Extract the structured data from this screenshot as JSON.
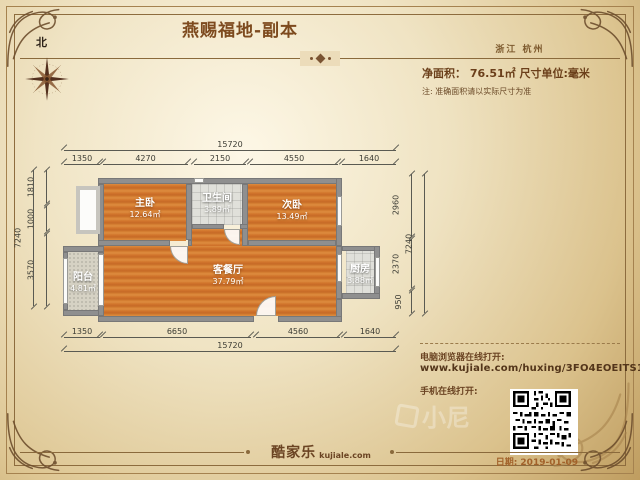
{
  "header": {
    "title": "燕赐福地-副本",
    "location": "浙江 杭州",
    "area_label": "净面积： 76.51㎡   尺寸单位:毫米",
    "note": "注: 准确面积请以实际尺寸为准",
    "compass_label": "北"
  },
  "plan": {
    "rooms": [
      {
        "name": "主卧",
        "area": "12.64㎡"
      },
      {
        "name": "卫生间",
        "area": "3.89㎡"
      },
      {
        "name": "次卧",
        "area": "13.49㎡"
      },
      {
        "name": "客餐厅",
        "area": "37.79㎡"
      },
      {
        "name": "阳台",
        "area": "4.81㎡"
      },
      {
        "name": "厨房",
        "area": "3.88㎡"
      }
    ],
    "dims": {
      "top_total": "15720",
      "top": [
        "1350",
        "4270",
        "2150",
        "4550",
        "1640"
      ],
      "bottom": [
        "1350",
        "6650",
        "4560",
        "1640"
      ],
      "bottom_total": "15720",
      "left": [
        "1810",
        "1000",
        "3570"
      ],
      "left_total": "7240",
      "right": [
        "2960",
        "2370",
        "950"
      ],
      "right_total": "7240"
    }
  },
  "footer": {
    "pc_open_label": "电脑浏览器在线打开:",
    "url": "www.kujiale.com/huxing/3FO4EOEITS10",
    "mobile_open_label": "手机在线打开:",
    "brand": "酷家乐",
    "brand_domain": "kujiale.com",
    "date": "日期: 2019-01-09",
    "watermark": "小尼"
  },
  "colors": {
    "accent_brown": "#7d4a1e",
    "wall_gray": "#8f8f8f",
    "wood_floor": "#d2752c",
    "tile_floor": "#d6d2c4",
    "parchment": "#ecdcba",
    "date_orange": "#a2622a"
  }
}
